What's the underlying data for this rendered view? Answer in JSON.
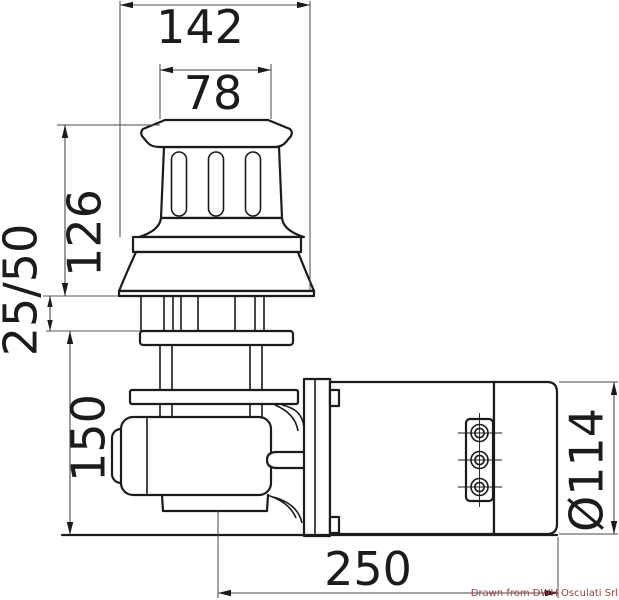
{
  "drawing": {
    "credit_note": "Drawn from DWH Osculati Srl",
    "colors": {
      "background": "#ffffff",
      "line": "#1b1b1b",
      "dim_line": "#4a4a4a",
      "deck_line": "#8f8f8f",
      "credit": "#9a4040"
    },
    "dimensions": {
      "base_width": "142",
      "drum_top_width": "78",
      "above_deck_height": "126",
      "deck_thickness_range": "25/50",
      "below_deck_height": "150",
      "overall_length_below_deck": "250",
      "motor_diameter": "Ø114"
    }
  }
}
